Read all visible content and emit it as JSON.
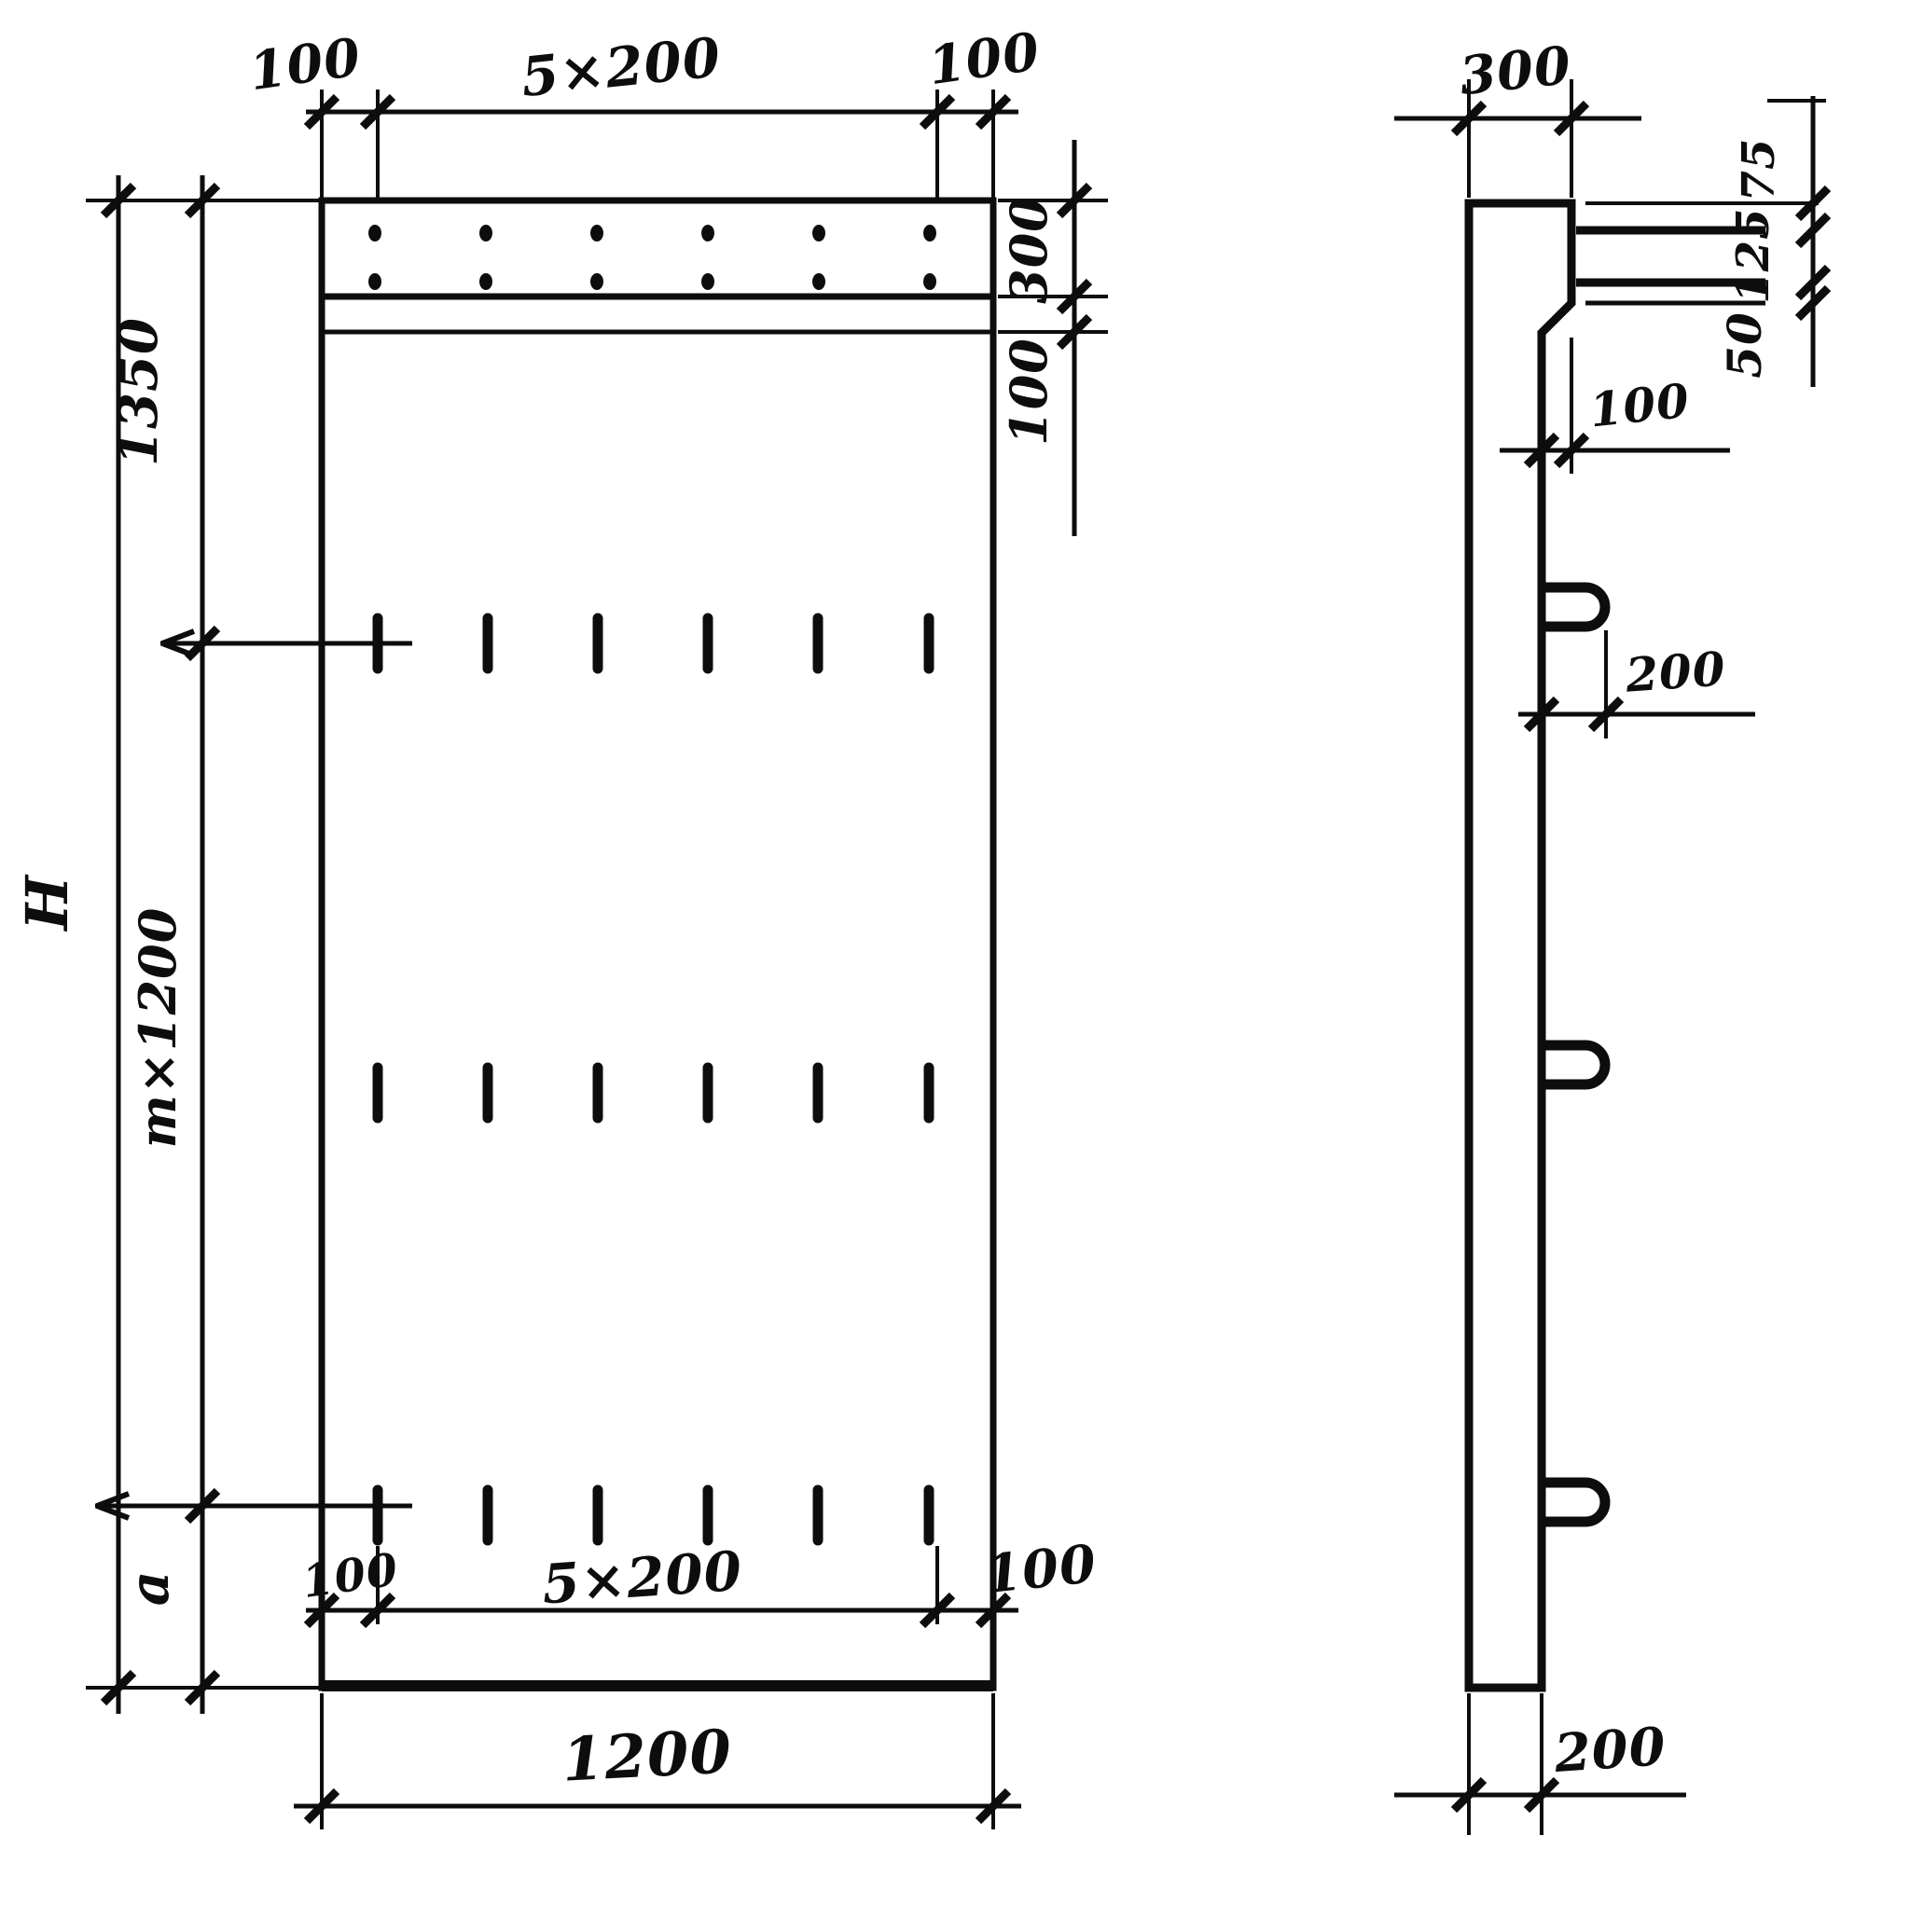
{
  "colors": {
    "ink": "#0d0d0d",
    "paper": "#ffffff"
  },
  "front_view": {
    "top_dim": {
      "left_margin": "100",
      "spacing": "5×200",
      "right_margin": "100"
    },
    "right_dim": {
      "band_height": "300",
      "strip_height": "100"
    },
    "left_dim": {
      "total_height": "H",
      "upper_segment": "1350",
      "middle_segment": "m×1200",
      "lower_segment": "a"
    },
    "bottom_dim": {
      "left_margin": "100",
      "spacing": "5×200",
      "right_margin": "100",
      "overall_width": "1200"
    }
  },
  "side_view": {
    "top_dim": "300",
    "right_dim": {
      "upper": "75",
      "middle": "125",
      "lower": "50"
    },
    "step_dim": "100",
    "loop_dim": "200",
    "bottom_dim": "200"
  }
}
